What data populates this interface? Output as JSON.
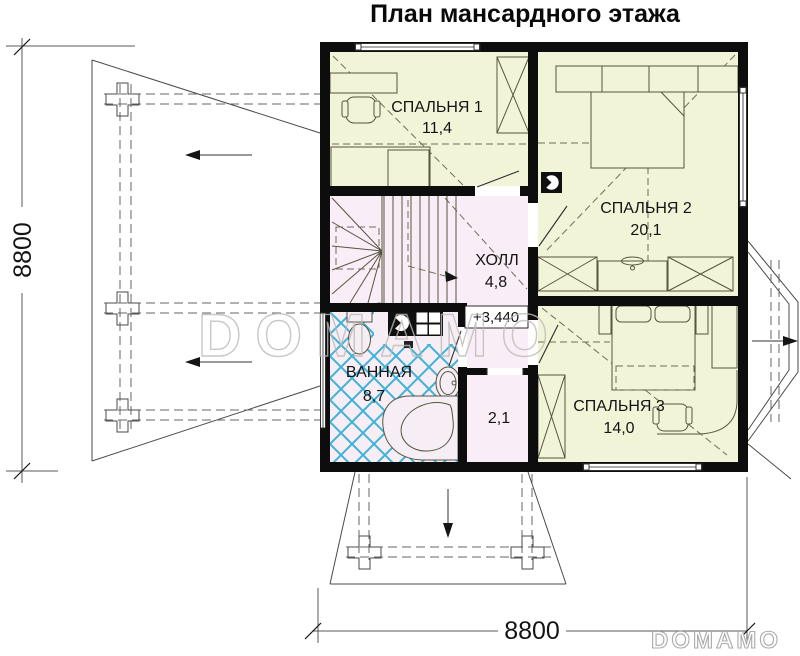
{
  "title": "План мансардного этажа",
  "rooms": [
    {
      "name": "СПАЛЬНЯ 1",
      "area": "11,4"
    },
    {
      "name": "СПАЛЬНЯ 2",
      "area": "20,1"
    },
    {
      "name": "ХОЛЛ",
      "area": "4,8"
    },
    {
      "name": "ВАННАЯ",
      "area": "8,7"
    },
    {
      "name": "СПАЛЬНЯ 3",
      "area": "14,0"
    },
    {
      "name": "",
      "area": "2,1"
    }
  ],
  "level_mark": "+3,440",
  "dimensions": {
    "left": "8800",
    "bottom": "8800"
  },
  "watermark": "DOMAMO",
  "logo": "DOMAMO",
  "colors": {
    "wall": "#0d0d0d",
    "room_fill": "#f1f4d7",
    "hall_fill": "#f9eef7",
    "bath_fill": "#f6edf5",
    "tile_line": "#3fb2d8",
    "bath_label": "#1aa6cd",
    "watermark": "#bdbab7"
  }
}
